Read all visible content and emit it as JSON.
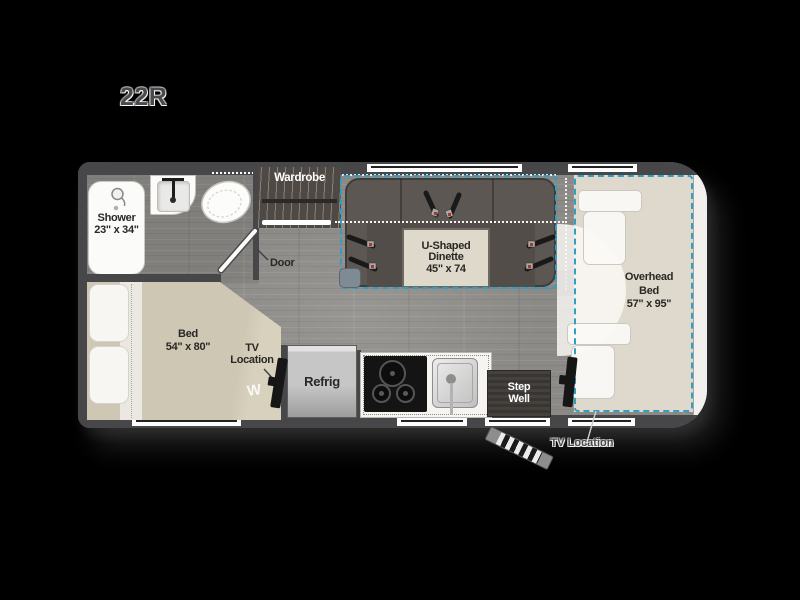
{
  "title": "22R",
  "plan": {
    "shower": {
      "label": "Shower",
      "dims": "23\" x 34\""
    },
    "wardrobe": {
      "label": "Wardrobe"
    },
    "door": {
      "label": "Door"
    },
    "dinette": {
      "line1": "U-Shaped",
      "line2": "Dinette",
      "dims": "45\" x 74"
    },
    "overhead_bed": {
      "line1": "Overhead",
      "line2": "Bed",
      "dims": "57\" x 95\""
    },
    "bed": {
      "label": "Bed",
      "dims": "54\" x 80\"",
      "logo": "W"
    },
    "tv_bedroom": {
      "line1": "TV",
      "line2": "Location"
    },
    "refrig": {
      "label": "Refrig"
    },
    "step_well": {
      "line1": "Step",
      "line2": "Well"
    },
    "tv_cab": {
      "label": "TV Location"
    }
  },
  "colors": {
    "slide_dashed": "#2f9fc4",
    "walls": "#47474a",
    "floor": "#8c8a86",
    "bed": "#cdc7b4",
    "overhead_bed_fill": "#e3ded1"
  }
}
